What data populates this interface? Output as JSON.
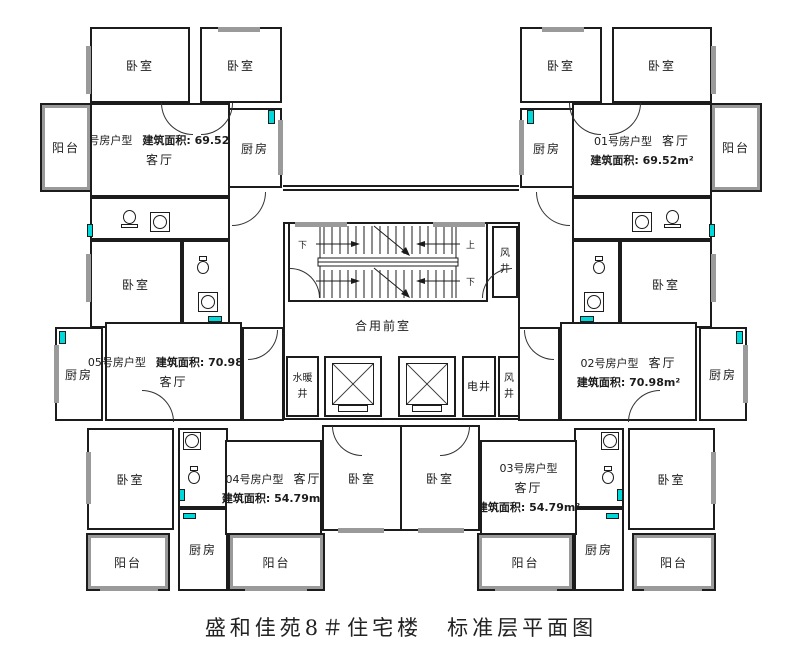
{
  "title": "盛和佳苑8＃住宅楼　标准层平面图",
  "rooms": {
    "bedroom": "卧室",
    "kitchen": "厨房",
    "balcony": "阳台",
    "living": "客厅"
  },
  "units": {
    "u06": {
      "name": "06号房户型",
      "area": "建筑面积: 69.52m²",
      "living": "客厅"
    },
    "u01": {
      "name": "01号房户型",
      "area": "建筑面积: 69.52m²",
      "living": "客厅"
    },
    "u05": {
      "name": "05号房户型",
      "area": "建筑面积: 70.98m²",
      "living": "客厅"
    },
    "u02": {
      "name": "02号房户型",
      "area": "建筑面积: 70.98m²",
      "living": "客厅"
    },
    "u04": {
      "name": "04号房户型",
      "area": "建筑面积: 54.79m²",
      "living": "客厅"
    },
    "u03": {
      "name": "03号房户型",
      "area": "建筑面积: 54.79m²",
      "living": "客厅"
    }
  },
  "core": {
    "lobby": "合用前室",
    "stair_up": "上",
    "stair_down": "下",
    "shaft_wind": "风\n井",
    "shaft_plumbing": "水暖井",
    "shaft_electrical": "电井"
  },
  "colors": {
    "wall": "#1c1c1c",
    "window": "#00d9d9",
    "glass": "#9a9a9a",
    "background": "#ffffff"
  }
}
